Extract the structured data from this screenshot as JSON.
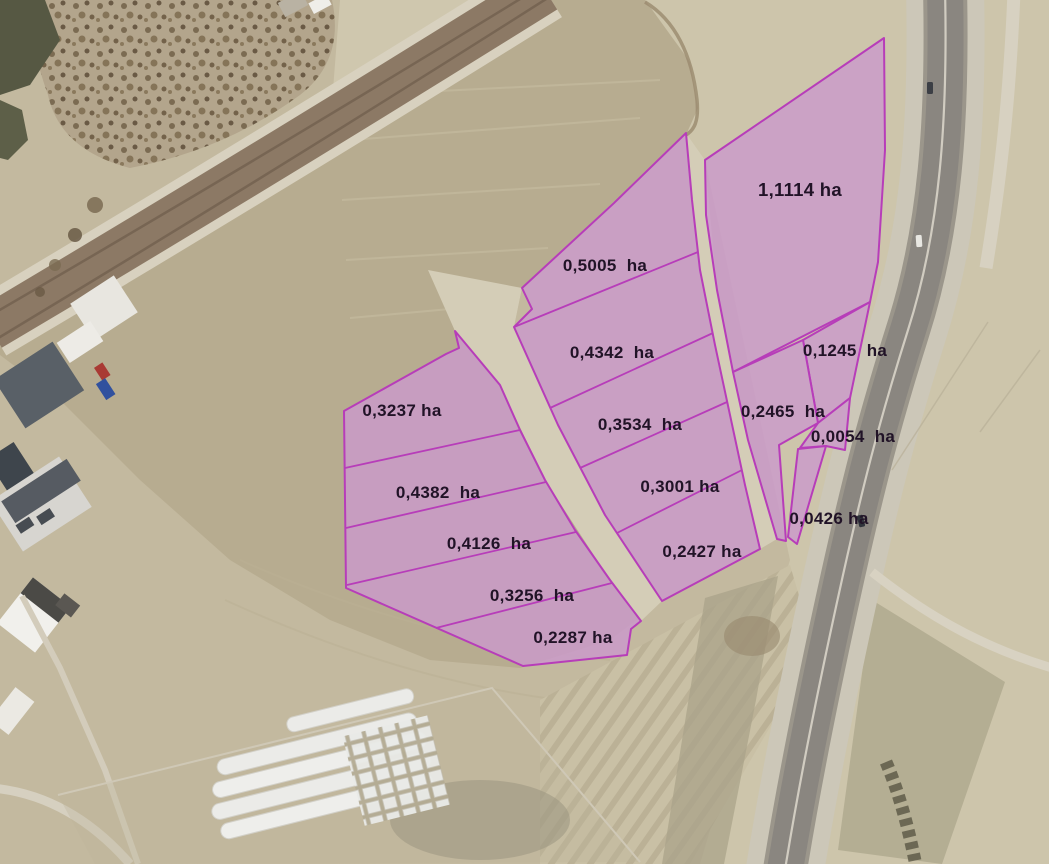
{
  "map": {
    "kind": "aerial-orthophoto-cadastral",
    "unit": "ha",
    "colors": {
      "parcel_fill": "#cb9aca",
      "parcel_border": "#b73db9",
      "label_text": "#211327",
      "terrain_base": "#c3b99f",
      "plowed_field": "#b7ac90",
      "highway_asphalt": "#8a8680",
      "railway": "#8c7965"
    },
    "parcels": [
      {
        "label": "0,3237 ha",
        "area_ha": "0,3237",
        "cluster": "west"
      },
      {
        "label": "0,4382  ha",
        "area_ha": "0,4382",
        "cluster": "west"
      },
      {
        "label": "0,4126  ha",
        "area_ha": "0,4126",
        "cluster": "west"
      },
      {
        "label": "0,3256  ha",
        "area_ha": "0,3256",
        "cluster": "west"
      },
      {
        "label": "0,2287 ha",
        "area_ha": "0,2287",
        "cluster": "west"
      },
      {
        "label": "0,5005  ha",
        "area_ha": "0,5005",
        "cluster": "central"
      },
      {
        "label": "0,4342  ha",
        "area_ha": "0,4342",
        "cluster": "central"
      },
      {
        "label": "0,3534  ha",
        "area_ha": "0,3534",
        "cluster": "central"
      },
      {
        "label": "0,3001 ha",
        "area_ha": "0,3001",
        "cluster": "central"
      },
      {
        "label": "0,2427 ha",
        "area_ha": "0,2427",
        "cluster": "central"
      },
      {
        "label": "1,1114 ha",
        "area_ha": "1,1114",
        "cluster": "east"
      },
      {
        "label": "0,1245  ha",
        "area_ha": "0,1245",
        "cluster": "east"
      },
      {
        "label": "0,2465  ha",
        "area_ha": "0,2465",
        "cluster": "east"
      },
      {
        "label": "0,0054  ha",
        "area_ha": "0,0054",
        "cluster": "east"
      },
      {
        "label": "0,0426 ha",
        "area_ha": "0,0426",
        "cluster": "east"
      }
    ]
  }
}
